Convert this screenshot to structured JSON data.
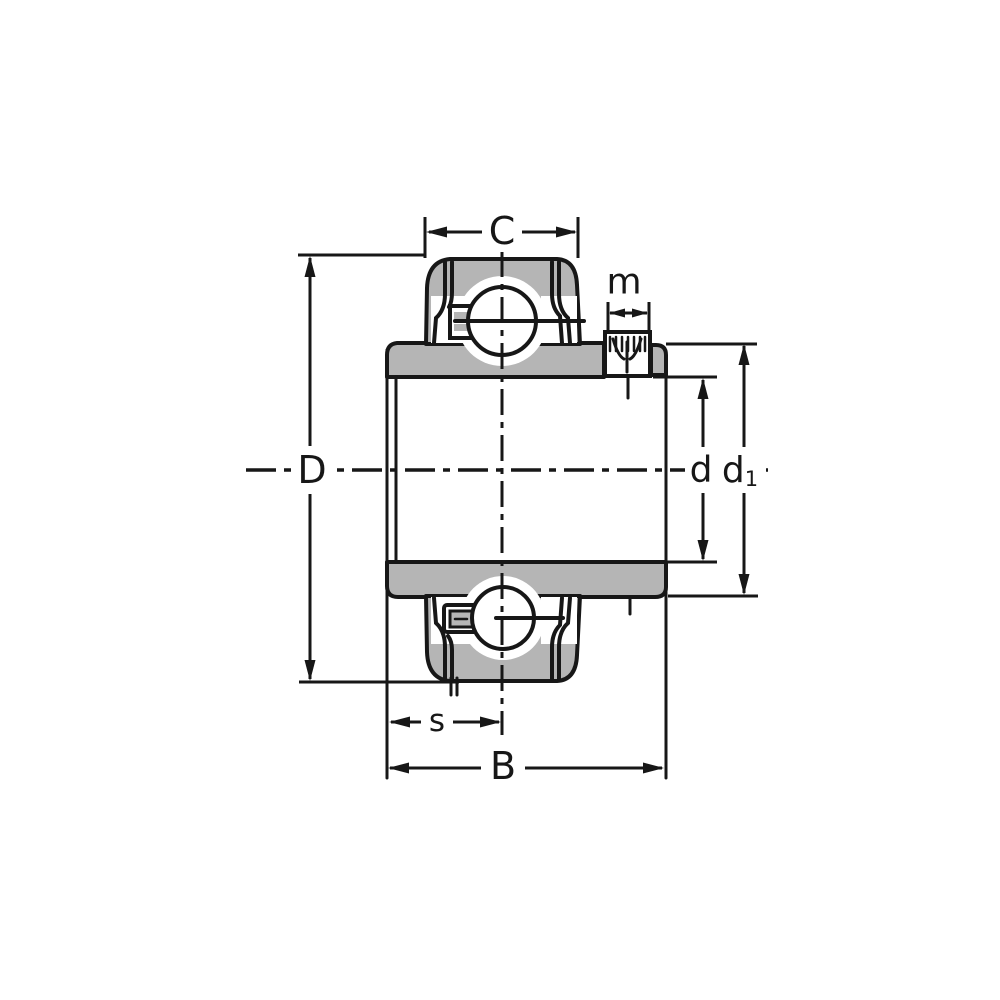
{
  "labels": {
    "c": "C",
    "m": "m",
    "D": "D",
    "d": "d",
    "d1_base": "d",
    "d1_sub": "1",
    "s": "s",
    "B": "B"
  },
  "colors": {
    "line": "#171717",
    "metal_fill": "#b5b5b5",
    "background": "#ffffff"
  }
}
